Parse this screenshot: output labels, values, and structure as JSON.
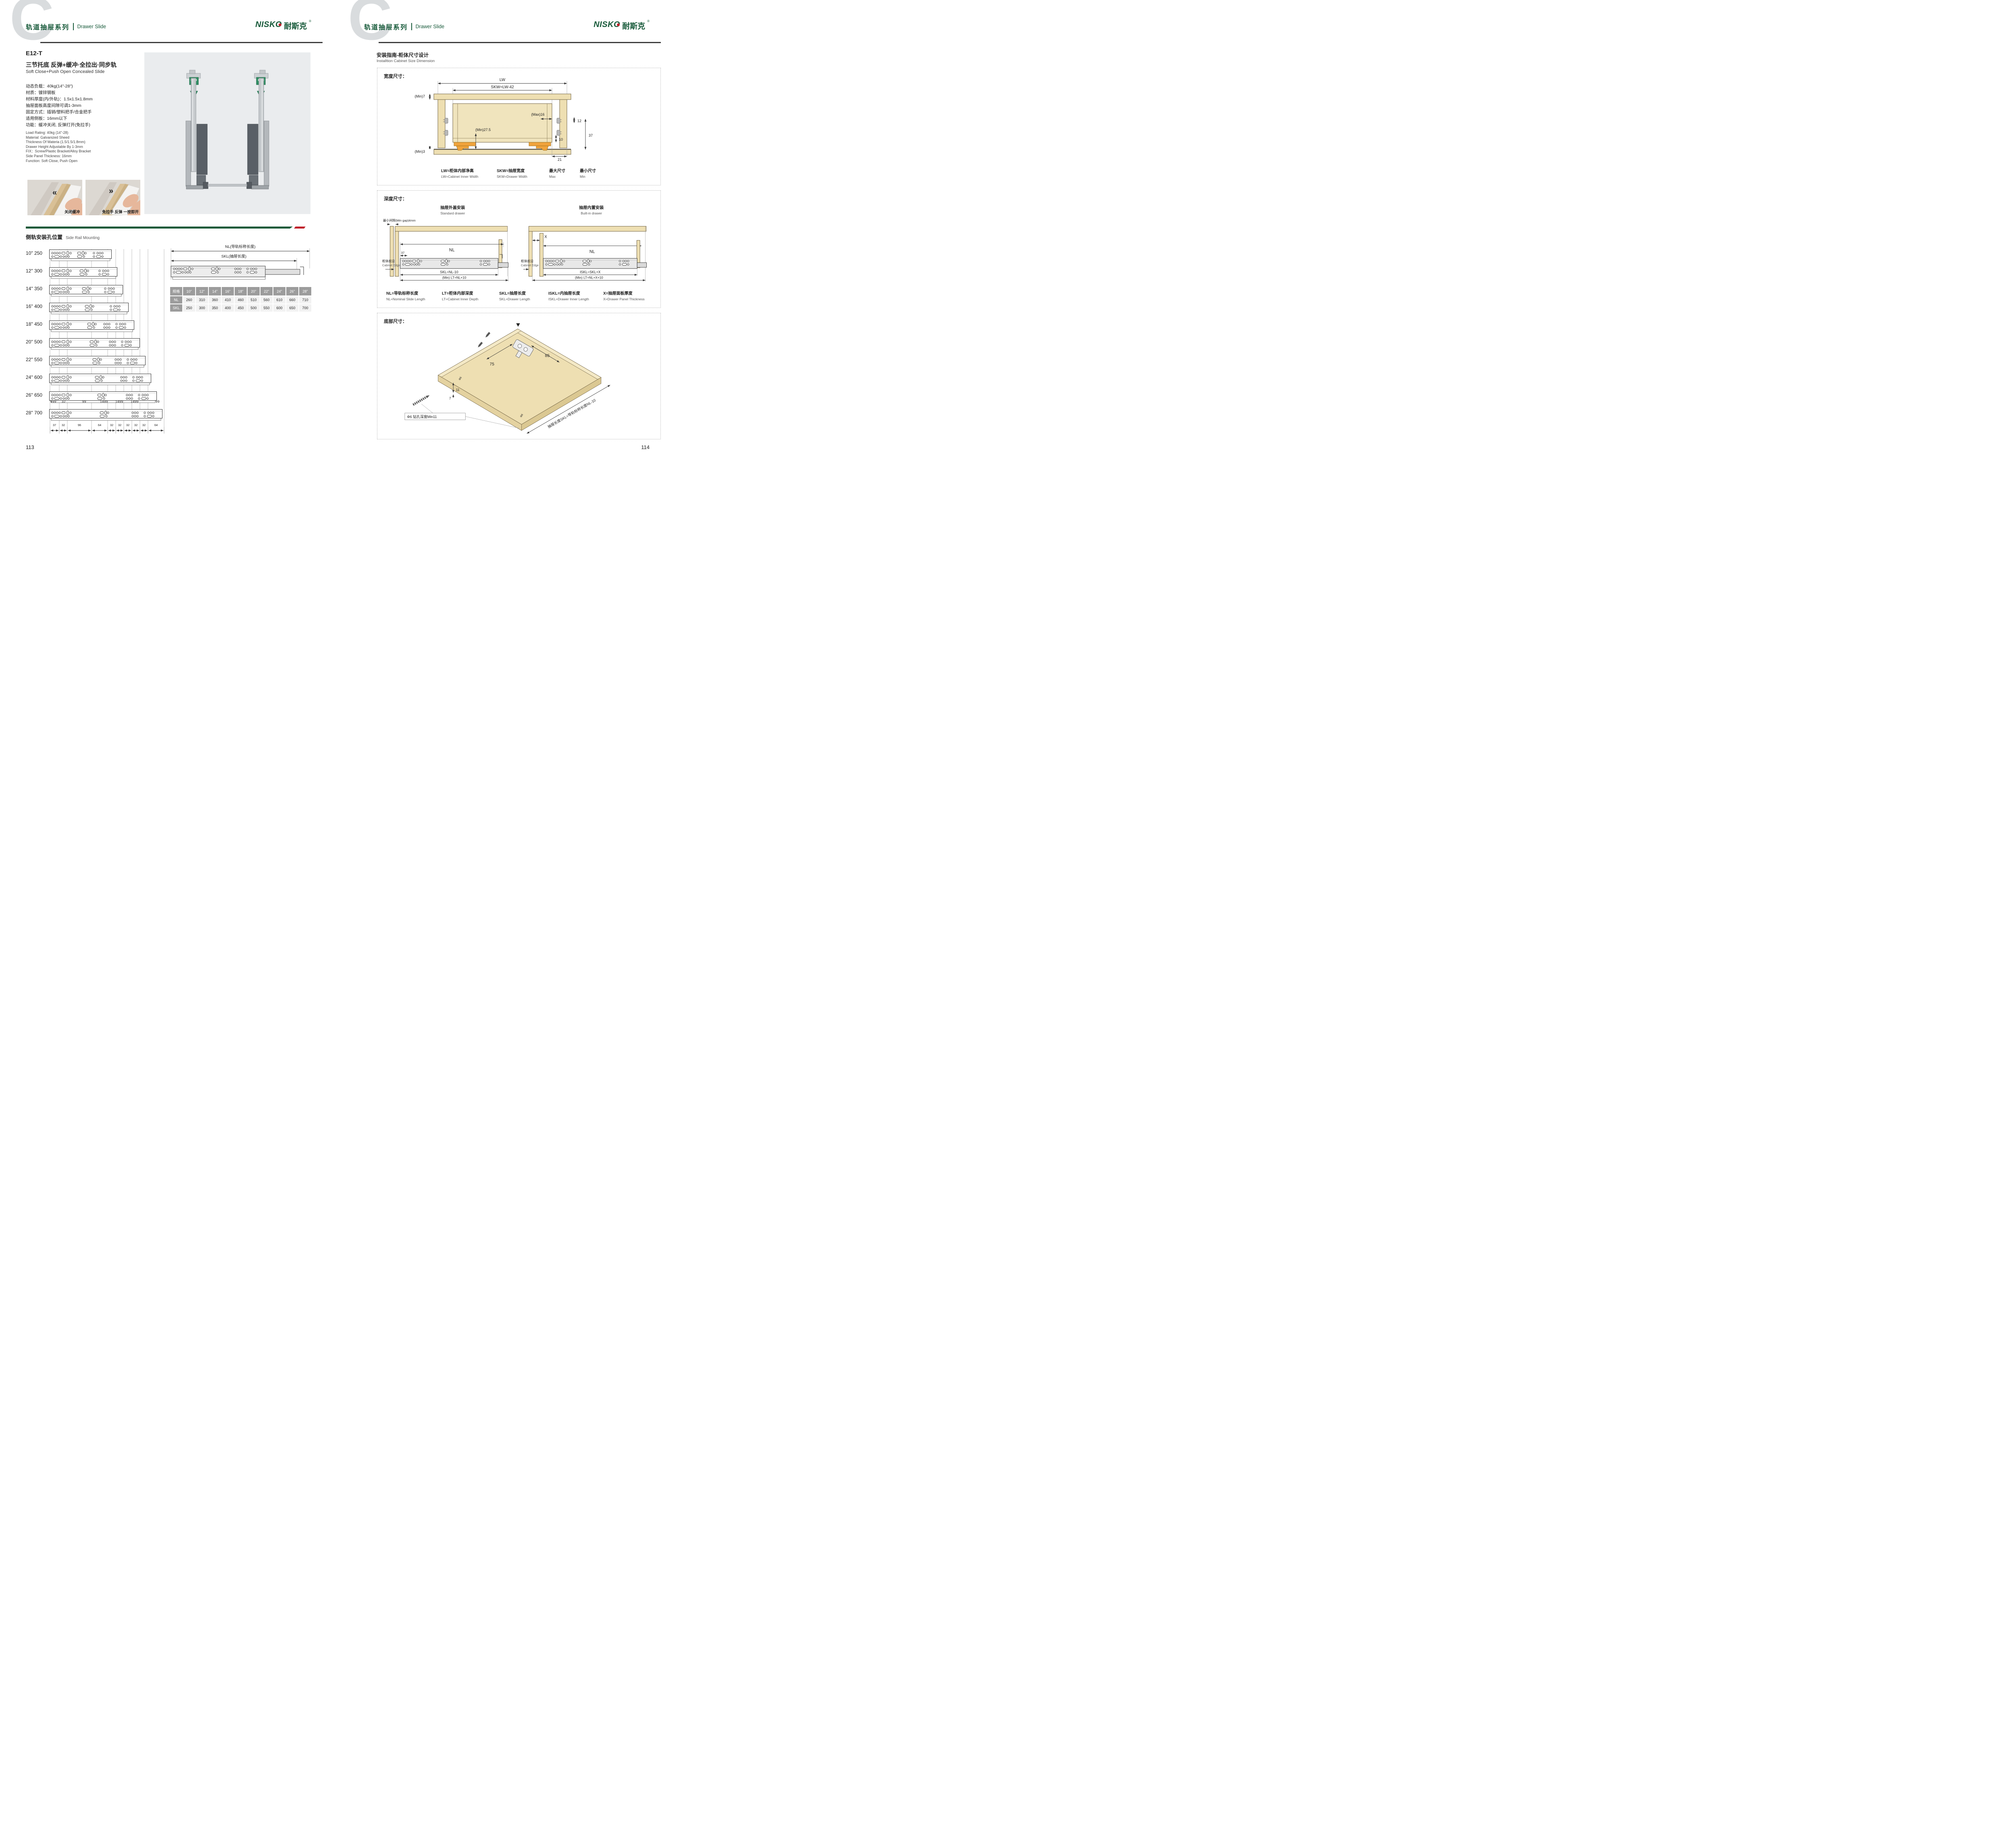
{
  "colors": {
    "brand_green": "#175a3a",
    "accent_red": "#c0222c",
    "wood_tan": "#eedfb2",
    "slide_orange": "#f0a33c",
    "table_header_gray": "#9c9c9c",
    "table_cell_gray": "#f2f2f2",
    "photo_bg": "#eaecee"
  },
  "icons": {
    "chevron_double_left": "«",
    "chevron_double_right": "»"
  },
  "brand": {
    "logo_text": "NISKO",
    "logo_cn": "耐斯克",
    "reg": "®",
    "watermark": "C"
  },
  "header": {
    "series_cn": "轨道抽屉系列",
    "series_en": "Drawer Slide"
  },
  "left_page": {
    "page_number": "113",
    "product": {
      "model": "E12-T",
      "name_cn": "三节托底 反弹+缓冲·全拉出·同步轨",
      "name_en": "Soft Close+Push Open Concealed Slide",
      "specs_cn": [
        "动态负载：40kg(14\"-28\")",
        "材质：镀锌钢板",
        "材料厚度(内/外轨)：1.5x1.5x1.8mm",
        "抽屉面板高度间隙可调1-3mm",
        "固定方式：插销/塑料把手/合金把手",
        "适用侧板：16mm以下",
        "功能：缓冲关闭, 反弹打开(免拉手)"
      ],
      "specs_en": [
        "Load Rating: 40kg (14\"-28)",
        "Material: Galvanized Sheed",
        "Thickness Of Materia (1.5/1.5/1.8mm)",
        "Drawer Height Adjustable By 1-3mm",
        "FIX：Screw/Plastic Bracket/Alloy Bracket",
        "Side Panel Thickness: 16mm",
        "Function: Soft Close, Push Open"
      ],
      "photo_captions": [
        "关闭缓冲",
        "免拉手 反弹 一按即开"
      ]
    },
    "side_rail": {
      "title_cn": "侧轨安装孔位置",
      "title_en": "Side Rail Mounting",
      "nl_dim_label": "NL(导轨标称长度)",
      "skl_dim_label": "SKL(抽屉长度)",
      "rows": [
        {
          "inch": "10\"",
          "mm": "250"
        },
        {
          "inch": "12\"",
          "mm": "300"
        },
        {
          "inch": "14\"",
          "mm": "350"
        },
        {
          "inch": "16\"",
          "mm": "400"
        },
        {
          "inch": "18\"",
          "mm": "450"
        },
        {
          "inch": "20\"",
          "mm": "500"
        },
        {
          "inch": "22\"",
          "mm": "550"
        },
        {
          "inch": "24\"",
          "mm": "600"
        },
        {
          "inch": "26\"",
          "mm": "650"
        },
        {
          "inch": "28\"",
          "mm": "700"
        }
      ],
      "top_dims": [
        "999",
        "32",
        "99",
        "1499",
        "1499",
        "1499",
        "99"
      ],
      "bottom_dims": [
        "37",
        "32",
        "96",
        "64",
        "32",
        "32",
        "32",
        "32",
        "32",
        "64"
      ]
    },
    "table": {
      "spec_header": "规格",
      "sizes": [
        "10\"",
        "12\"",
        "14\"",
        "16\"",
        "18\"",
        "20\"",
        "22\"",
        "24\"",
        "26\"",
        "28\""
      ],
      "nl_label": "NL",
      "nl_values": [
        "260",
        "310",
        "360",
        "410",
        "460",
        "510",
        "560",
        "610",
        "660",
        "710"
      ],
      "skl_label": "SKL",
      "skl_values": [
        "250",
        "300",
        "350",
        "400",
        "450",
        "500",
        "550",
        "600",
        "650",
        "700"
      ]
    }
  },
  "right_page": {
    "page_number": "114",
    "title_cn": "安装指南-柜体尺寸设计",
    "title_en": "Installtion Cabinet Size Dimension",
    "width_section": {
      "label": "宽度尺寸：",
      "dims": {
        "lw": "LW",
        "skw": "SKW=LW-42",
        "min7": "(Min)7",
        "max16": "(Max)16",
        "d12": "12",
        "d10": "10",
        "d37": "37",
        "min275": "(Min)27.5",
        "min3": "(Min)3",
        "d21": "21"
      },
      "legend": [
        {
          "cn": "LW=柜体内部净高",
          "en": "LW=Cabinet Inner Width"
        },
        {
          "cn": "SKW=抽屉宽度",
          "en": "SKW=Drawer Width"
        },
        {
          "cn": "最大尺寸",
          "en": "Max"
        },
        {
          "cn": "最小尺寸",
          "en": "Min"
        }
      ]
    },
    "depth_section": {
      "label": "深度尺寸：",
      "min_gap": "最小间隙(Min gap)4mm",
      "standard": {
        "title_cn": "抽屉外盖安装",
        "title_en": "Standard drawer",
        "nl": "NL",
        "d37": "37",
        "skl": "SKL=NL-10",
        "lt": "(Min) LT=NL+10",
        "edge_cn": "柜体前沿",
        "edge_en": "Cabinet Edge"
      },
      "builtin": {
        "title_cn": "抽屉内置安装",
        "title_en": "Built-in drawer",
        "x": "X",
        "nl": "NL",
        "iskl": "ISKL=SKL+X",
        "lt": "(Min) LT=NL+X+10",
        "edge_cn": "柜体前沿",
        "edge_en": "Cabinet Edge"
      },
      "legend": [
        {
          "cn": "NL=导轨标称长度",
          "en": "NL=Nominal Slide Length"
        },
        {
          "cn": "LT=柜体内部深度",
          "en": "LT=Cabinet Inner Depth"
        },
        {
          "cn": "SKL=抽屉长度",
          "en": "SKL=Drawer Length"
        },
        {
          "cn": "ISKL=内抽屉长度",
          "en": "ISKL=Drawer Inner Length"
        },
        {
          "cn": "X=抽屉面板厚度",
          "en": "X=Drawer Panel Thickness"
        }
      ]
    },
    "bottom_section": {
      "label": "底部尺寸：",
      "dims": {
        "d75": "75",
        "d85": "85",
        "d11": "11",
        "d7": "7",
        "phi6": "Φ6",
        "drill": "Φ6 钻孔深度Min11",
        "skl_note": "抽屉长度SKL=导轨标称长度NL-10"
      }
    }
  }
}
